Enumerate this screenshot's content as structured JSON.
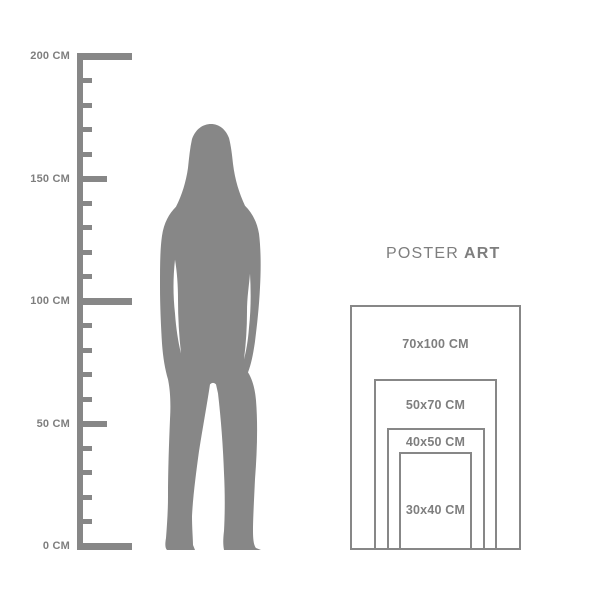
{
  "title": {
    "poster": "POSTER",
    "art": "ART"
  },
  "ruler": {
    "unit": "CM",
    "min": 0,
    "max": 200,
    "minor_step": 10,
    "mid_step": 50,
    "major_step": 100,
    "labels": [
      {
        "value": 200,
        "text": "200 CM"
      },
      {
        "value": 150,
        "text": "150 CM"
      },
      {
        "value": 100,
        "text": "100 CM"
      },
      {
        "value": 50,
        "text": "50 CM"
      },
      {
        "value": 0,
        "text": "0 CM"
      }
    ]
  },
  "size_chart": {
    "unit": "CM",
    "sizes": [
      {
        "label": "70x100 CM",
        "width_cm": 70,
        "height_cm": 100
      },
      {
        "label": "50x70 CM",
        "width_cm": 50,
        "height_cm": 70
      },
      {
        "label": "40x50 CM",
        "width_cm": 40,
        "height_cm": 50
      },
      {
        "label": "30x40 CM",
        "width_cm": 30,
        "height_cm": 40
      }
    ]
  },
  "colors": {
    "graphic_gray": "#878787",
    "text_gray": "#7e7e7e",
    "background": "#ffffff"
  }
}
